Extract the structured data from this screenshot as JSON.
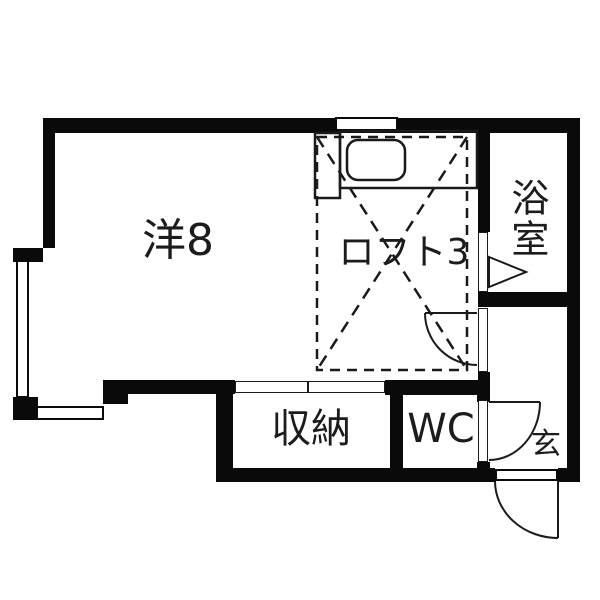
{
  "floorplan": {
    "type": "japanese-apartment-floor-plan",
    "rooms": {
      "western": {
        "label": "洋8",
        "meaning": "western-style room 8 mats"
      },
      "loft": {
        "label": "ロフト3",
        "meaning": "loft 3 mats"
      },
      "bathroom": {
        "label": "浴室",
        "meaning": "bath room"
      },
      "storage": {
        "label": "収納",
        "meaning": "storage closet"
      },
      "toilet": {
        "label": "WC",
        "meaning": "toilet"
      },
      "entrance": {
        "label": "玄",
        "meaning": "entrance (genkan)"
      }
    },
    "colors": {
      "wall": "#0a0a0a",
      "background": "#ffffff",
      "line": "#1a1a1a",
      "text": "#1c1c1c"
    }
  }
}
